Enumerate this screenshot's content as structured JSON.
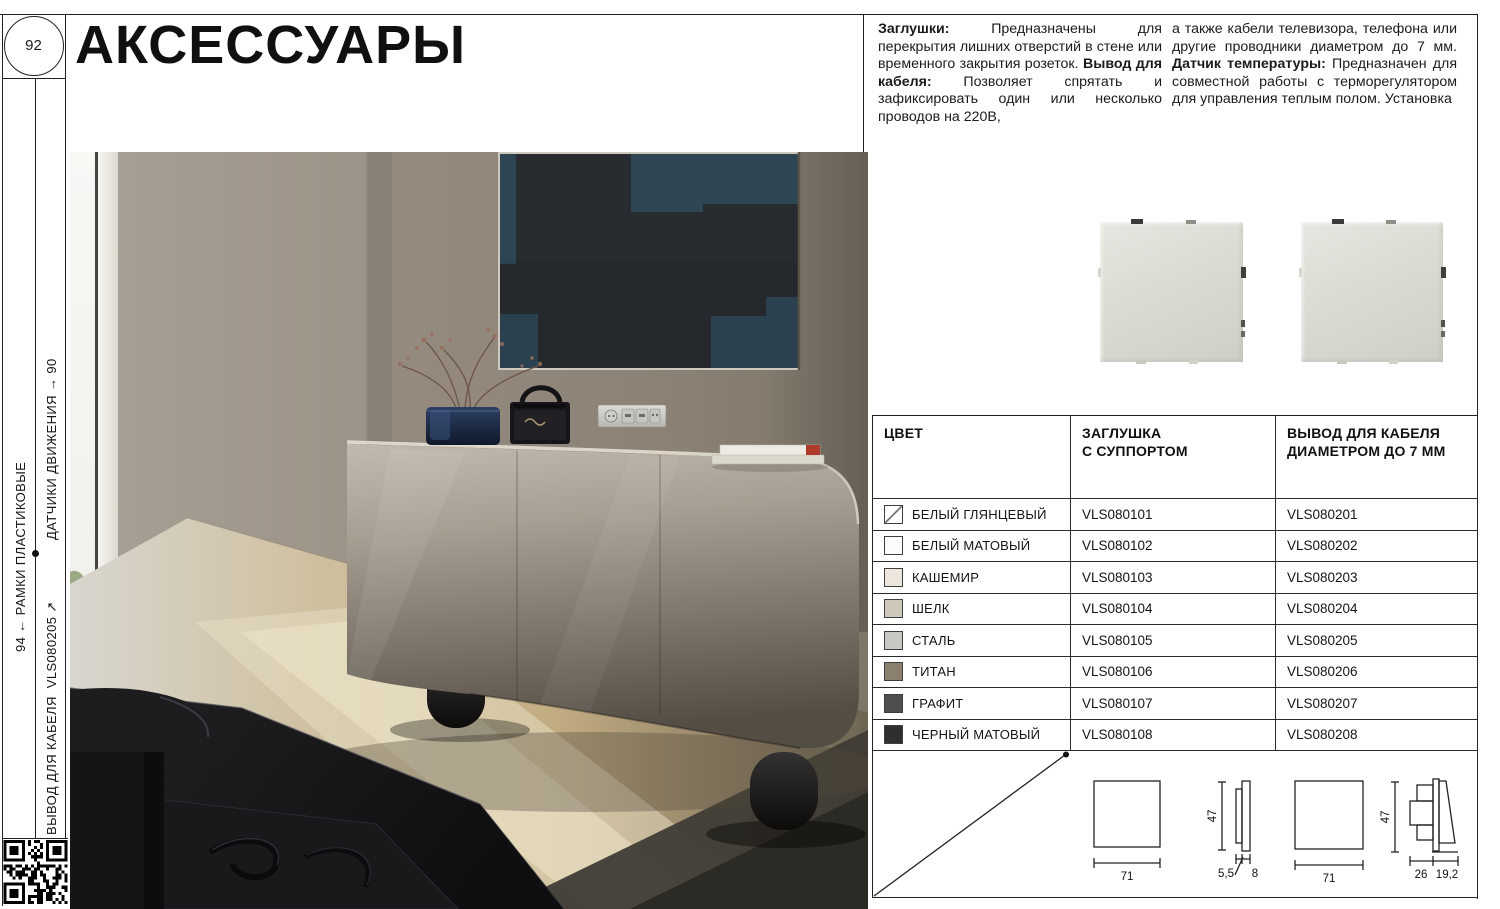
{
  "page": {
    "number": "92",
    "title": "АКСЕССУАРЫ"
  },
  "sidebar": {
    "nav_prev_section": "ДАТЧИКИ ДВИЖЕНИЯ → 90",
    "nav_parent_section": "94 ← РАМКИ ПЛАСТИКОВЫЕ",
    "nav_current_section": "ВЫВОД ДЛЯ КАБЕЛЯ  VLS080205 ↗"
  },
  "description": {
    "col1_seg1_bold": "Заглушки:",
    "col1_seg1_text": " Предназначены для перекрытия лишних отверстий в стене или временного закрытия розеток. ",
    "col1_seg2_bold": "Вывод для кабеля:",
    "col1_seg2_text": " Позволяет спрятать и зафиксировать один или несколько проводов на 220В,",
    "col2_seg1_text": "а также кабели телевизора, телефона или другие проводники диаметром до 7 мм. ",
    "col2_seg2_bold": "Датчик температуры:",
    "col2_seg2_text": " Предназначен для совместной работы с терморегулятором для управления теплым полом. Установка"
  },
  "table": {
    "headers": [
      "ЦВЕТ",
      "ЗАГЛУШКА\nС СУППОРТОМ",
      "ВЫВОД ДЛЯ КАБЕЛЯ\nДИАМЕТРОМ ДО 7 ММ"
    ],
    "rows": [
      {
        "name": "БЕЛЫЙ ГЛЯНЦЕВЫЙ",
        "swatch": "#ffffff",
        "a1": "VLS080101",
        "a2": "VLS080201"
      },
      {
        "name": "БЕЛЫЙ МАТОВЫЙ",
        "swatch": "#fbfbf9",
        "a1": "VLS080102",
        "a2": "VLS080202"
      },
      {
        "name": "КАШЕМИР",
        "swatch": "#ece6dc",
        "a1": "VLS080103",
        "a2": "VLS080203"
      },
      {
        "name": "ШЕЛК",
        "swatch": "#cdc8ba",
        "a1": "VLS080104",
        "a2": "VLS080204"
      },
      {
        "name": "СТАЛЬ",
        "swatch": "#c7c8c3",
        "a1": "VLS080105",
        "a2": "VLS080205"
      },
      {
        "name": "ТИТАН",
        "swatch": "#8b7f70",
        "a1": "VLS080106",
        "a2": "VLS080206"
      },
      {
        "name": "ГРАФИТ",
        "swatch": "#4e4e50",
        "a1": "VLS080107",
        "a2": "VLS080207"
      },
      {
        "name": "ЧЕРНЫЙ МАТОВЫЙ",
        "swatch": "#2f2f31",
        "a1": "VLS080108",
        "a2": "VLS080208"
      }
    ]
  },
  "dimensions": {
    "plug": {
      "front_width": "71",
      "height": "47",
      "support_depth": "5,5",
      "plate_depth": "8"
    },
    "cable_outlet": {
      "front_width": "71",
      "height": "47",
      "body_depth": "26",
      "wedge_depth": "19,2"
    }
  }
}
